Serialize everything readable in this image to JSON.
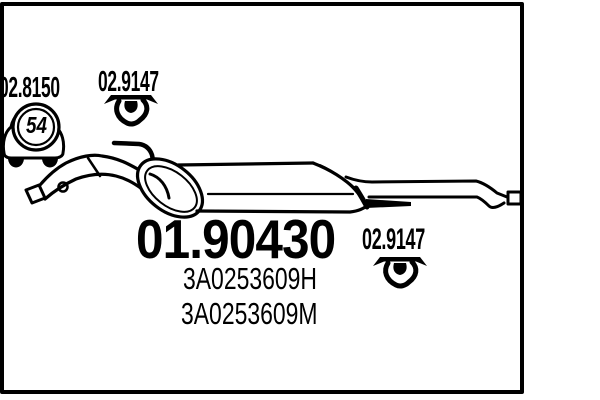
{
  "colors": {
    "ink": "#000000",
    "paper": "#ffffff"
  },
  "diagram": {
    "main_code": "01.90430",
    "oem_numbers": [
      "3A0253609H",
      "3A0253609M"
    ],
    "car_badge": "54",
    "accessories": {
      "car_kit_code": "02.8150",
      "clamp_top_code": "02.9147",
      "clamp_bottom_code": "02.9147"
    }
  }
}
